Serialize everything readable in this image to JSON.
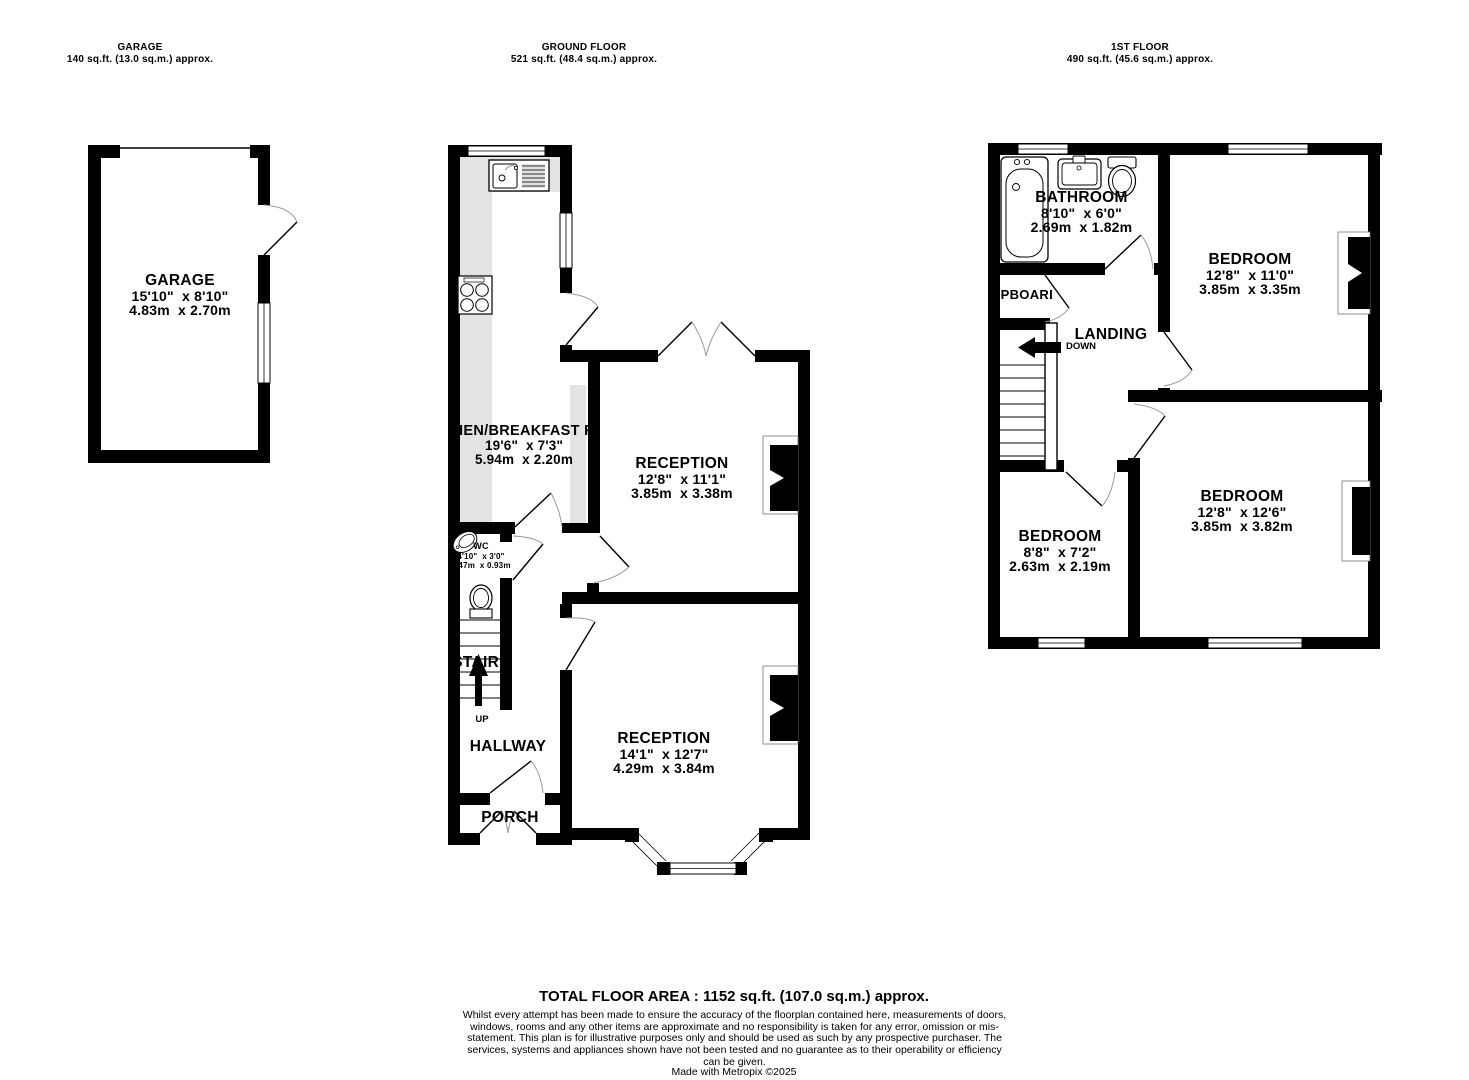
{
  "headers": {
    "garage": {
      "title": "GARAGE",
      "area": "140 sq.ft. (13.0 sq.m.) approx."
    },
    "ground_floor": {
      "title": "GROUND FLOOR",
      "area": "521 sq.ft. (48.4 sq.m.) approx."
    },
    "first_floor": {
      "title": "1ST FLOOR",
      "area": "490 sq.ft. (45.6 sq.m.) approx."
    }
  },
  "rooms": {
    "garage": {
      "name": "GARAGE",
      "imperial": "15'10\"  x 8'10\"",
      "metric": "4.83m  x 2.70m"
    },
    "kitchen": {
      "name": "KITCHEN/BREAKFAST ROOM",
      "imperial": "19'6\"  x 7'3\"",
      "metric": "5.94m  x 2.20m"
    },
    "wc": {
      "name": "WC",
      "imperial": "4'10\"  x 3'0\"",
      "metric": "1.47m  x 0.93m"
    },
    "reception1": {
      "name": "RECEPTION",
      "imperial": "12'8\"  x 11'1\"",
      "metric": "3.85m  x 3.38m"
    },
    "reception2": {
      "name": "RECEPTION",
      "imperial": "14'1\"  x 12'7\"",
      "metric": "4.29m  x 3.84m"
    },
    "hallway": {
      "name": "HALLWAY"
    },
    "porch": {
      "name": "PORCH"
    },
    "stairs": {
      "name": "STAIRS",
      "up": "UP"
    },
    "bathroom": {
      "name": "BATHROOM",
      "imperial": "8'10\"  x 6'0\"",
      "metric": "2.69m  x 1.82m"
    },
    "cupboard": {
      "name": "CUPBOARD"
    },
    "landing": {
      "name": "LANDING",
      "down": "DOWN"
    },
    "bedroom1": {
      "name": "BEDROOM",
      "imperial": "12'8\"  x 11'0\"",
      "metric": "3.85m  x 3.35m"
    },
    "bedroom2": {
      "name": "BEDROOM",
      "imperial": "12'8\"  x 12'6\"",
      "metric": "3.85m  x 3.82m"
    },
    "bedroom3": {
      "name": "BEDROOM",
      "imperial": "8'8\"  x 7'2\"",
      "metric": "2.63m  x 2.19m"
    }
  },
  "footer": {
    "total": "TOTAL FLOOR AREA : 1152 sq.ft. (107.0 sq.m.) approx.",
    "disclaimer": "Whilst every attempt has been made to ensure the accuracy of the floorplan contained here, measurements of doors, windows, rooms and any other items are approximate and no responsibility is taken for any error, omission or mis-statement. This plan is for illustrative purposes only and should be used as such by any prospective purchaser. The services, systems and appliances shown have not been tested and no guarantee as to their operability or efficiency can be given.",
    "credit": "Made with Metropix ©2025"
  }
}
